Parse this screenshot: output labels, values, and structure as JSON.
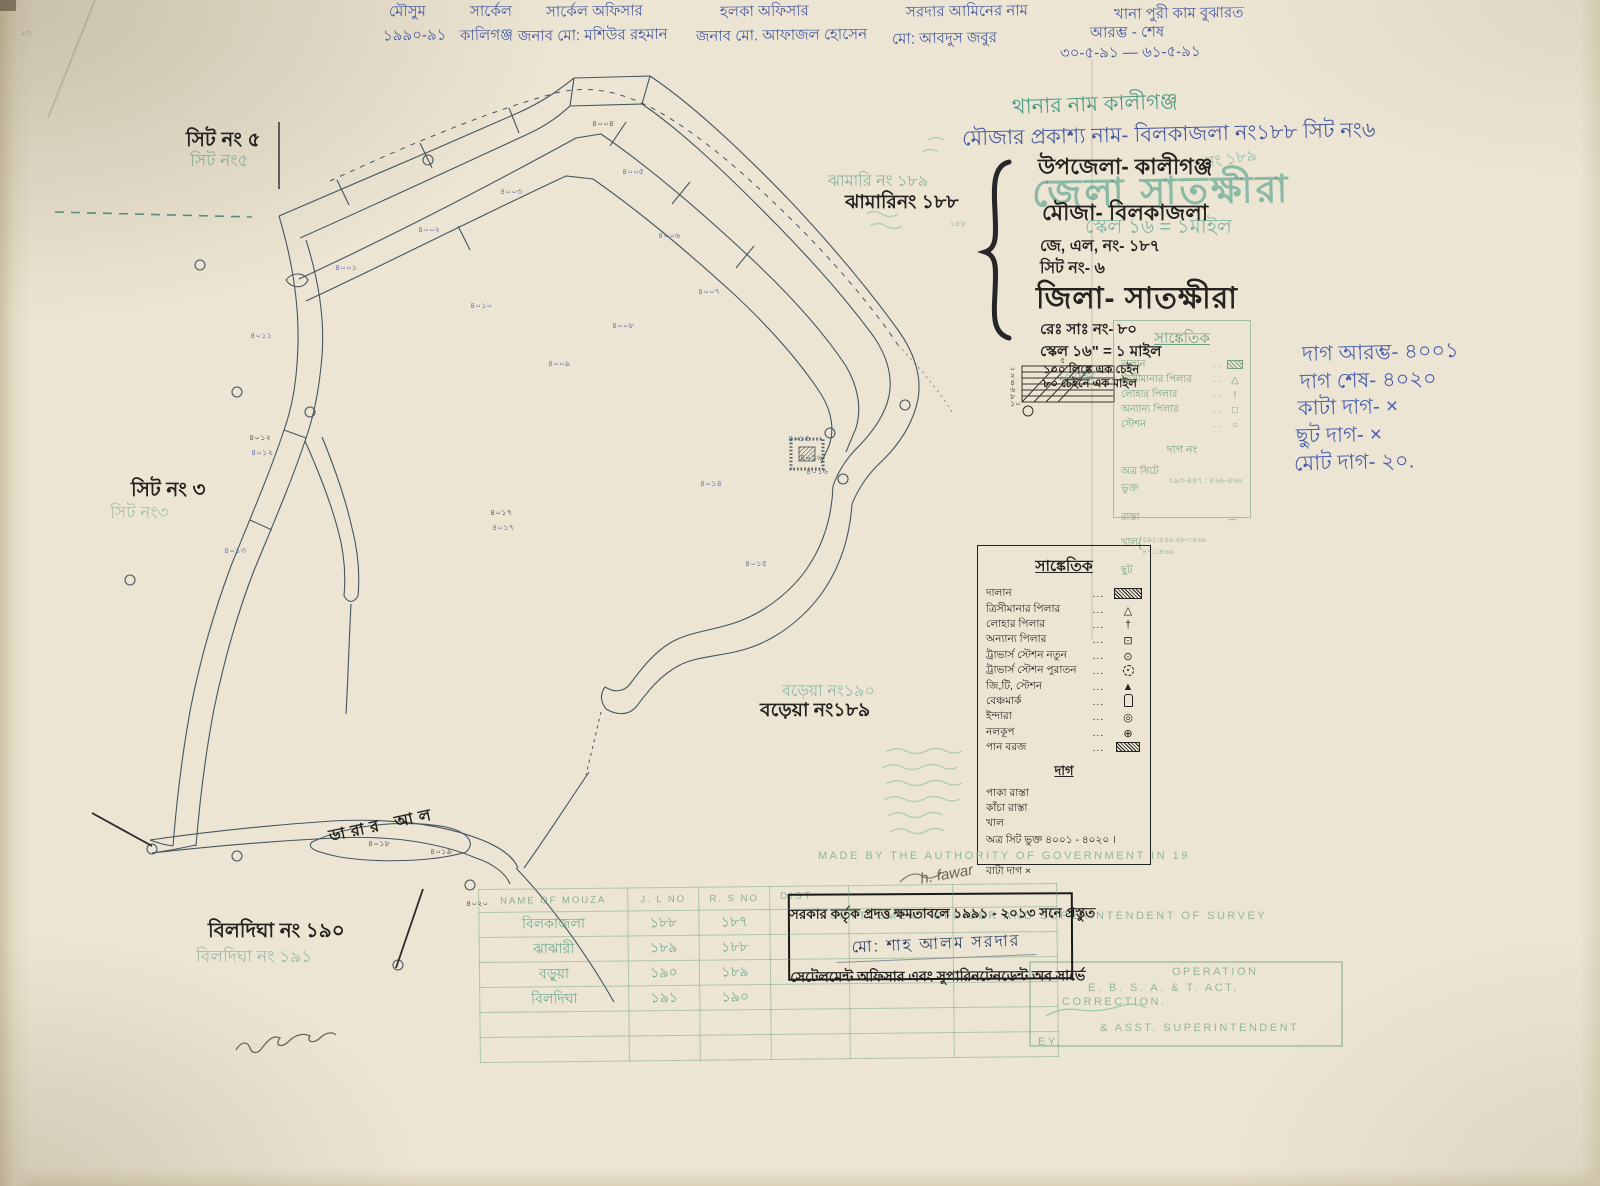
{
  "colors": {
    "paper": "#ece5d3",
    "ink": "#25231f",
    "blue": "#47599e",
    "teal": "#2f8a72",
    "teal_faint": "#93c1ac",
    "map_line": "#46555e"
  },
  "header": {
    "items": [
      {
        "x": 383,
        "segs": [
          {
            "t": "মৌসুম",
            "dx": 6,
            "dy": 0
          },
          {
            "t": "১৯৯০-৯১",
            "dx": 0,
            "dy": 24
          }
        ]
      },
      {
        "x": 460,
        "segs": [
          {
            "t": "সার্কেল",
            "dx": 10,
            "dy": 0
          },
          {
            "t": "কালিগঞ্জ",
            "dx": 0,
            "dy": 24
          }
        ]
      },
      {
        "x": 518,
        "segs": [
          {
            "t": "সার্কেল অফিসার",
            "dx": 28,
            "dy": 0
          },
          {
            "t": "জনাব মো: মশিউর রহমান",
            "dx": 0,
            "dy": 24
          }
        ]
      },
      {
        "x": 696,
        "segs": [
          {
            "t": "হলকা অফিসার",
            "dx": 24,
            "dy": 0
          },
          {
            "t": "জনাব মো. আফাজল হোসেন",
            "dx": 0,
            "dy": 24
          }
        ]
      },
      {
        "x": 888,
        "segs": [
          {
            "t": "সরদার আমিনের নাম",
            "dx": 18,
            "dy": 0
          },
          {
            "t": "মো: আবদুস  জবুর",
            "dx": 4,
            "dy": 27
          }
        ]
      },
      {
        "x": 1060,
        "segs": [
          {
            "t": "খানা পুরী কাম বুঝারত",
            "dx": 54,
            "dy": 2
          },
          {
            "t": "আরম্ভ  -  শেষ",
            "dx": 30,
            "dy": 21
          },
          {
            "t": "৩০-৫-৯১ —  ৬১-৫-৯১",
            "dx": 0,
            "dy": 41
          }
        ]
      }
    ]
  },
  "title_block": {
    "thana_name": "থানার নাম  কালীগঞ্জ",
    "mouza_public": "মৌজার প্রকাশ্য নাম- বিলকাজলা নং১৮৮ সিট নং৬",
    "upazila": "উপজেলা- কালীগঞ্জ",
    "mouza": "মৌজা-  বিলকাজলা",
    "jl_no": "জে, এল, নং- ১৮৭",
    "sheet_no": "সিট নং-  ৬",
    "district": "জিলা- সাতক্ষীরা",
    "rs_no": "রেঃ সাঃ নং-  ৮০",
    "scale": "স্কেল ১৬\" = ১ মাইল",
    "stamp_district": "জেলা সাতক্ষীরা",
    "stamp_scale": "স্কেল ১৬ = ১মাইল",
    "stamp_no": "নং ১৮৯"
  },
  "scale_block": {
    "note1": "১০০ লিঙ্কে এক চেইন",
    "note2": "৮০ চেইনে এক মাইল",
    "bar_label": "১০ চেইন",
    "ticks": [
      "০",
      "২",
      "৪",
      "৬",
      "৮",
      "১০"
    ],
    "top_tick": "৫"
  },
  "green_legend": {
    "title": "সাঙ্কেতিক",
    "items": [
      {
        "label": "দালান",
        "symbol": "g-hatch"
      },
      {
        "label": "ত্রিসীমানার পিলার",
        "symbol": "g-tri"
      },
      {
        "label": "লোহার পিলার",
        "symbol": "g-cross"
      },
      {
        "label": "অন্যান্য পিলার",
        "symbol": "g-sq"
      },
      {
        "label": "স্টেশন",
        "symbol": "g-circ"
      }
    ],
    "dag_no": "দাগ নং",
    "atra_label": "অত্র সিটে ভুক্ত",
    "atra_value": "২৯৩-৪৪৭ : ৪৬৬-৪৬৮",
    "rasta": "রাস্তা",
    "khal": "খাল",
    "khal_value1": "৫৯১:৫৪৯:৫৮০:৪৬৮",
    "khal_value2": "৪৭১:৪৬৬",
    "chhut": "ছুট"
  },
  "blue_notes": [
    "দাগ আরম্ভ-  ৪০০১",
    "দাগ শেষ-  ৪০২০",
    "কাটা দাগ-   ×",
    "ছুট দাগ-   ×",
    "মোট দাগ-  ২০."
  ],
  "black_legend": {
    "title": "সাঙ্কেতিক",
    "items": [
      {
        "label": "দালান",
        "symbol": "hatched-rect"
      },
      {
        "label": "ত্রিসীমানার পিলার",
        "symbol": "triangle-dot"
      },
      {
        "label": "লোহার পিলার",
        "symbol": "iron-cross"
      },
      {
        "label": "অন্যান্য পিলার",
        "symbol": "square-dot"
      },
      {
        "label": "ট্রাভার্স স্টেশন নতুন",
        "symbol": "circle-dot"
      },
      {
        "label": "ট্রাভার্স স্টেশন পুরাতন",
        "symbol": "dashed-circle-dot"
      },
      {
        "label": "জি,টি, স্টেশন",
        "symbol": "filled-triangle"
      },
      {
        "label": "বেঞ্চমার্ক",
        "symbol": "benchmark"
      },
      {
        "label": "ইন্দারা",
        "symbol": "double-circle"
      },
      {
        "label": "নলকূপ",
        "symbol": "circle-plus"
      },
      {
        "label": "পান বরজ",
        "symbol": "hatched-rect-small"
      }
    ],
    "dag_title": "দাগ",
    "dag_items": [
      "পাকা রাস্তা",
      "কাঁচা রাস্তা",
      "খাল"
    ],
    "atra_line": "অত্র সিট ভুক্ত  ৪০০১ - ৪০২০ ।",
    "bata": "বাটা দাগ  ×"
  },
  "stamp_box": {
    "line1": "সরকার কর্তৃক প্রদত্ত ক্ষমতাবলে ১৯৯১ - ২০১৩ সনে প্রস্তুত",
    "signature": "মো: শাহ আলম সরদার",
    "line2": "সেটেলমেন্ট অফিসার এবং সুপারিনটেনডেন্ট অব সার্ভে"
  },
  "green_stamps": {
    "made_by": "MADE BY THE AUTHORITY OF GOVERNMENT IN 19",
    "settlement": "SETTLEMENT OFFICER AND SUPERINTENDENT OF SURVEY",
    "pencil_sig": "h. fawar",
    "operation": "OPERATION",
    "act_line": "E. B. S. A. & T. ACT,",
    "correction": "CORRECTION.",
    "asst": "& ASST. SUPERINTENDENT",
    "of_survey": "EY.",
    "dist": "DIST"
  },
  "mouza_table": {
    "headers": [
      "NAME OF MOUZA",
      "J. L NO",
      "R. S NO",
      "",
      "",
      ""
    ],
    "rows": [
      [
        "বিলকাজলা",
        "১৮৮",
        "১৮৭",
        "",
        "",
        ""
      ],
      [
        "ঝাঝারী",
        "১৮৯",
        "১৮৮",
        "",
        "",
        ""
      ],
      [
        "বড়ুয়া",
        "১৯০",
        "১৮৯",
        "",
        "",
        ""
      ],
      [
        "বিলদিঘা",
        "১৯১",
        "১৯০",
        "",
        "",
        ""
      ]
    ]
  },
  "map_labels": {
    "sheet5_black": "সিট নং ৫",
    "sheet5_green": "সিট নং৫",
    "sheet3_black": "সিট নং ৩",
    "sheet3_green": "সিট নং৩",
    "jhamari_green": "ঝামারি নং ১৮৯",
    "jhamari_black": "ঝামারিনং ১৮৮",
    "boreya_green": "বড়েয়া নং১৯০",
    "boreya_black": "বড়েয়া নং১৮৯",
    "bildigha_black": "বিলদিঘা নং ১৯০",
    "bildigha_green": "বিলদিঘা নং ১৯১",
    "canal": "ডারার আল",
    "corner_mark": "২০"
  },
  "plot_numbers": [
    {
      "x": 335,
      "y": 262,
      "t": "৪০০১",
      "c": "b"
    },
    {
      "x": 418,
      "y": 224,
      "t": "৪০০২",
      "c": "b"
    },
    {
      "x": 500,
      "y": 186,
      "t": "৪০০৩",
      "c": "b"
    },
    {
      "x": 592,
      "y": 118,
      "t": "৪০০৪",
      "c": "k"
    },
    {
      "x": 622,
      "y": 166,
      "t": "৪০০৫",
      "c": "b"
    },
    {
      "x": 658,
      "y": 230,
      "t": "৪০০৬",
      "c": "b"
    },
    {
      "x": 698,
      "y": 286,
      "t": "৪০০৭",
      "c": "b"
    },
    {
      "x": 612,
      "y": 320,
      "t": "৪০০৮",
      "c": "b"
    },
    {
      "x": 548,
      "y": 358,
      "t": "৪০০৯",
      "c": "b"
    },
    {
      "x": 470,
      "y": 300,
      "t": "৪০১০",
      "c": "b"
    },
    {
      "x": 250,
      "y": 330,
      "t": "৪০১১",
      "c": "b"
    },
    {
      "x": 249,
      "y": 432,
      "t": "৪০১২",
      "c": "k"
    },
    {
      "x": 251,
      "y": 447,
      "t": "৪০১২",
      "c": "b"
    },
    {
      "x": 224,
      "y": 545,
      "t": "৪০১৩",
      "c": "b"
    },
    {
      "x": 700,
      "y": 478,
      "t": "৪০১৪",
      "c": "b"
    },
    {
      "x": 745,
      "y": 558,
      "t": "৪০১৫",
      "c": "b"
    },
    {
      "x": 788,
      "y": 433,
      "t": "৪০১৫",
      "c": "b"
    },
    {
      "x": 800,
      "y": 452,
      "t": "৪০১৬",
      "c": "k"
    },
    {
      "x": 806,
      "y": 466,
      "t": "৪০১৬",
      "c": "b"
    },
    {
      "x": 490,
      "y": 507,
      "t": "৪০১৭",
      "c": "k"
    },
    {
      "x": 492,
      "y": 522,
      "t": "৪০১৭",
      "c": "b"
    },
    {
      "x": 368,
      "y": 838,
      "t": "৪০১৮",
      "c": "k"
    },
    {
      "x": 430,
      "y": 846,
      "t": "৪০১৯",
      "c": "k"
    },
    {
      "x": 466,
      "y": 898,
      "t": "৪০২০",
      "c": "k"
    },
    {
      "x": 950,
      "y": 218,
      "t": "১৮৮",
      "c": "g"
    }
  ],
  "stations": [
    [
      200,
      265
    ],
    [
      237,
      392
    ],
    [
      130,
      580
    ],
    [
      428,
      160
    ],
    [
      310,
      412
    ],
    [
      830,
      433
    ],
    [
      843,
      479
    ],
    [
      152,
      849
    ],
    [
      237,
      856
    ],
    [
      470,
      885
    ],
    [
      398,
      965
    ],
    [
      905,
      405
    ]
  ]
}
